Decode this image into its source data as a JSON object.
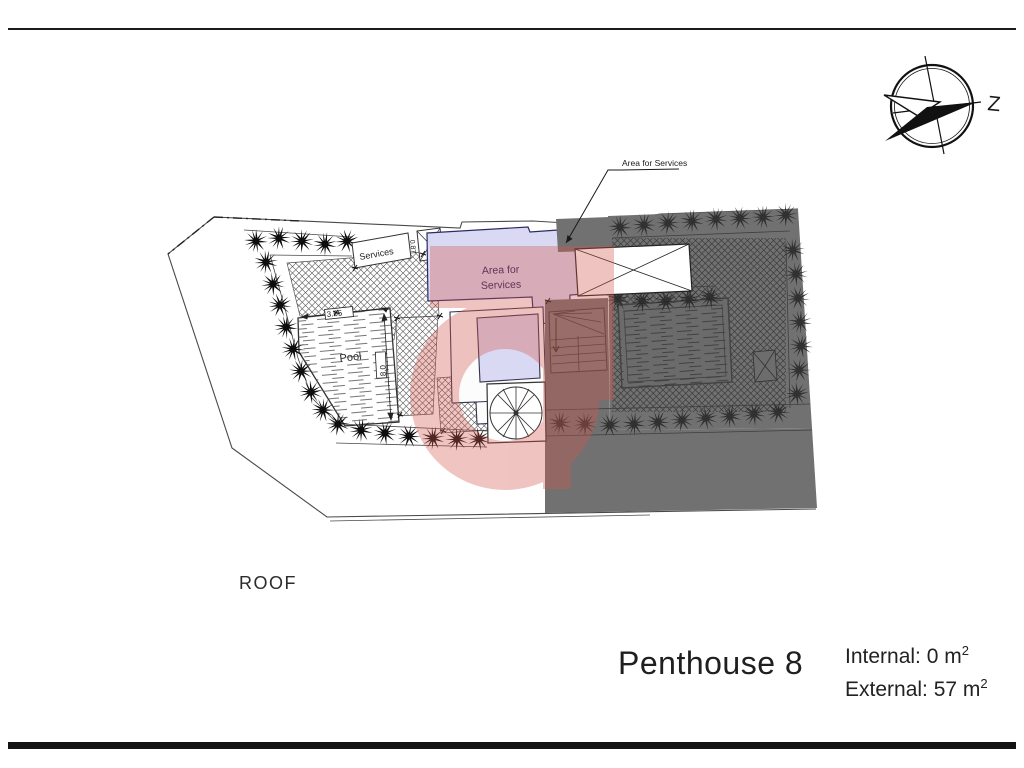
{
  "compass": {
    "label": "Z"
  },
  "callout": {
    "text": "Area for Services"
  },
  "plan": {
    "area_line1": "Area for",
    "area_line2": "Services",
    "services_label": "Services",
    "pool_label": "Pool",
    "dim_pool_width": "3.65",
    "dim_pool_length": "8.0",
    "dim_services": "0.87"
  },
  "footer": {
    "floor_label": "ROOF",
    "unit_name": "Penthouse 8",
    "internal_text": "Internal: 0 m",
    "internal_sup": "2",
    "external_text": "External: 57 m",
    "external_sup": "2"
  },
  "colors": {
    "watermark": "#d4584e",
    "lavender": "#d9d9f3",
    "lavender_border": "#2b2b66",
    "gray_zone": "#717171",
    "line": "#3a3a3a"
  }
}
